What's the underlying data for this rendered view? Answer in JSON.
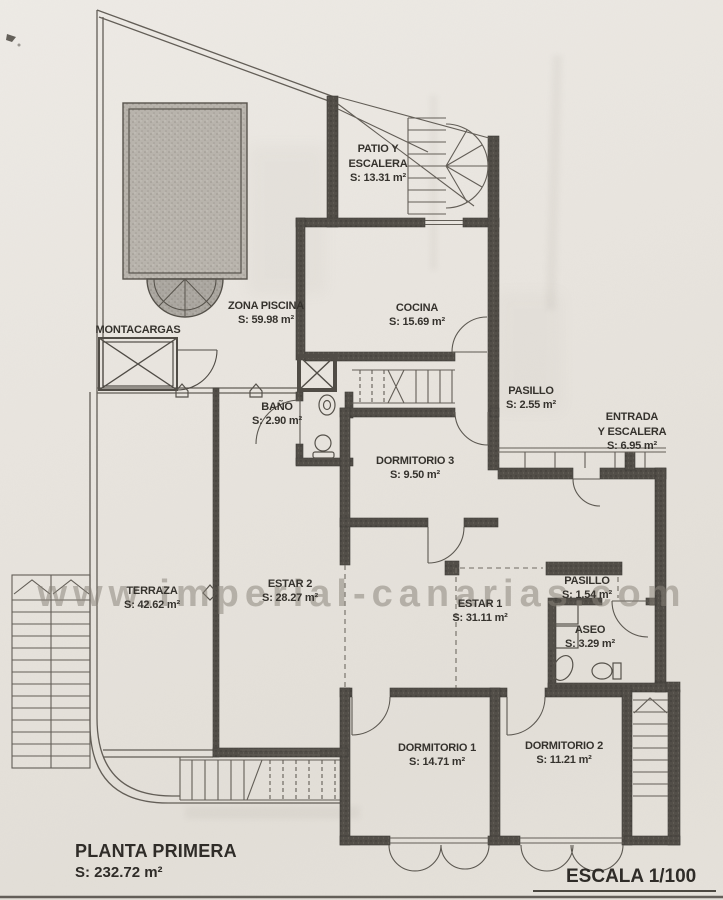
{
  "watermark": "www.imperial-canarias.com",
  "rooms": {
    "patio_escalera": {
      "line1": "PATIO Y",
      "line2": "ESCALERA",
      "area": "S: 13.31 m²"
    },
    "zona_piscina": {
      "name": "ZONA PISCINA",
      "area": "S: 59.98 m²"
    },
    "montacargas": {
      "name": "MONTACARGAS"
    },
    "cocina": {
      "name": "COCINA",
      "area": "S: 15.69 m²"
    },
    "pasillo_superior": {
      "name": "PASILLO",
      "area": "S: 2.55 m²"
    },
    "entrada_escalera": {
      "line1": "ENTRADA",
      "line2": "Y ESCALERA",
      "area": "S: 6.95 m²"
    },
    "bano": {
      "name": "BAÑO",
      "area": "S: 2.90 m²"
    },
    "dormitorio3": {
      "name": "DORMITORIO 3",
      "area": "S: 9.50 m²"
    },
    "terraza": {
      "name": "TERRAZA",
      "area": "S: 42.62 m²"
    },
    "estar2": {
      "name": "ESTAR 2",
      "area": "S: 28.27 m²"
    },
    "estar1": {
      "name": "ESTAR 1",
      "area": "S: 31.11 m²"
    },
    "pasillo_inferior": {
      "name": "PASILLO",
      "area": "S: 1.54 m²"
    },
    "aseo": {
      "name": "ASEO",
      "area": "S: 3.29 m²"
    },
    "dormitorio1": {
      "name": "DORMITORIO 1",
      "area": "S: 14.71 m²"
    },
    "dormitorio2": {
      "name": "DORMITORIO 2",
      "area": "S: 11.21 m²"
    }
  },
  "footer": {
    "plan_title": "PLANTA PRIMERA",
    "plan_area": "S: 232.72 m²",
    "scale": "ESCALA 1/100"
  },
  "colors": {
    "paper": "#e9e5df",
    "ink": "#35322d",
    "wall": "#4f4b45",
    "line": "#625d56",
    "pool": "#b9b4ad",
    "watermark": "#8a8479"
  }
}
